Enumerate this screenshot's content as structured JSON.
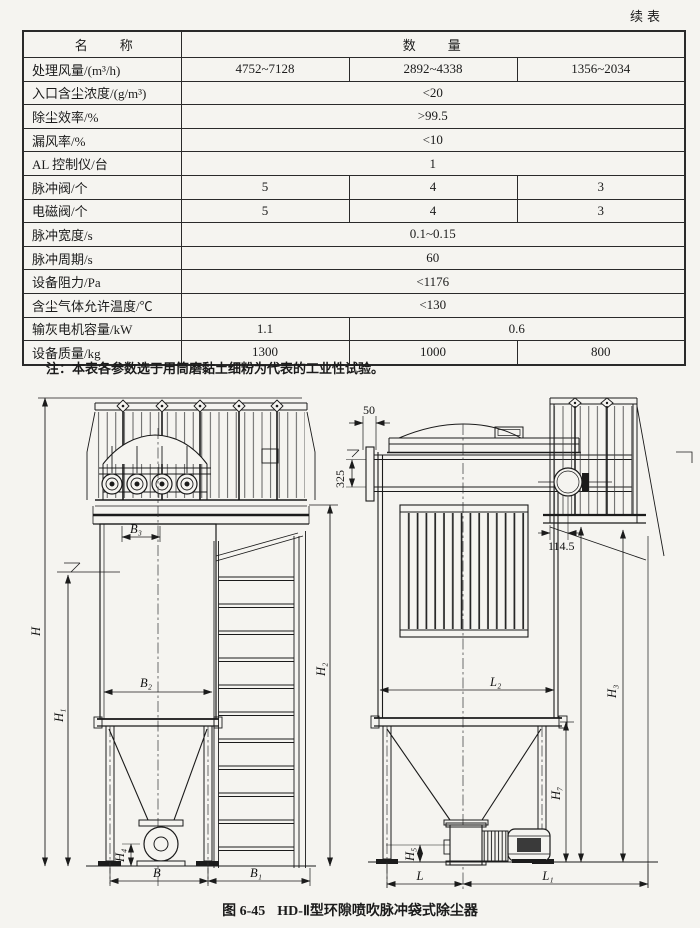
{
  "page": {
    "continued_label": "续表"
  },
  "table": {
    "header": {
      "name_col": "名　　称",
      "qty_col": "数　　量"
    },
    "rows": [
      {
        "label": "处理风量/(m³/h)",
        "cells": [
          {
            "t": "4752~7128"
          },
          {
            "t": "2892~4338"
          },
          {
            "t": "1356~2034"
          }
        ]
      },
      {
        "label": "入口含尘浓度/(g/m³)",
        "cells": [
          {
            "t": "<20"
          }
        ]
      },
      {
        "label": "除尘效率/%",
        "cells": [
          {
            "t": ">99.5"
          }
        ]
      },
      {
        "label": "漏风率/%",
        "cells": [
          {
            "t": "<10"
          }
        ]
      },
      {
        "label": "AL 控制仪/台",
        "cells": [
          {
            "t": "1"
          }
        ]
      },
      {
        "label": "脉冲阀/个",
        "cells": [
          {
            "t": "5"
          },
          {
            "t": "4"
          },
          {
            "t": "3"
          }
        ]
      },
      {
        "label": "电磁阀/个",
        "cells": [
          {
            "t": "5"
          },
          {
            "t": "4"
          },
          {
            "t": "3"
          }
        ]
      },
      {
        "label": "脉冲宽度/s",
        "cells": [
          {
            "t": "0.1~0.15"
          }
        ]
      },
      {
        "label": "脉冲周期/s",
        "cells": [
          {
            "t": "60"
          }
        ]
      },
      {
        "label": "设备阻力/Pa",
        "cells": [
          {
            "t": "<1176"
          }
        ]
      },
      {
        "label": "含尘气体允许温度/℃",
        "cells": [
          {
            "t": "<130"
          }
        ]
      },
      {
        "label": "输灰电机容量/kW",
        "cells": [
          {
            "t": "1.1"
          },
          {
            "t": "0.6"
          }
        ]
      },
      {
        "label": "设备质量/kg",
        "cells": [
          {
            "t": "1300"
          },
          {
            "t": "1000"
          },
          {
            "t": "800"
          }
        ]
      }
    ]
  },
  "note": "注：本表各参数选于用筒磨黏土细粉为代表的工业性试验。",
  "caption": {
    "figure_no": "图 6-45",
    "title": "HD-Ⅱ型环隙喷吹脉冲袋式除尘器"
  },
  "diagram": {
    "front": {
      "H": "H",
      "H1": "H₁",
      "H2": "H₂",
      "H4": "H₄",
      "B": "B",
      "B1": "B₁",
      "B2": "B₂",
      "B3": "B₃"
    },
    "side": {
      "d50": "50",
      "d325": "325",
      "d114": "114.5",
      "H3": "H₃",
      "H5": "H₅",
      "H7": "H₇",
      "L": "L",
      "L1": "L₁",
      "L2": "L₂"
    }
  }
}
